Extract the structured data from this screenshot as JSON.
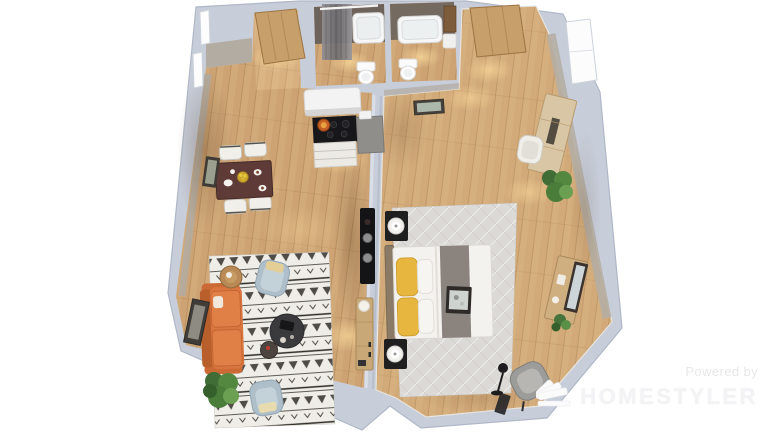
{
  "watermark": {
    "powered_by": "Powered by",
    "brand": "HOMESTYLER",
    "logo": "homestyler-fan-logo"
  },
  "scene": {
    "type": "3d-floor-plan-render",
    "view": "top-down dollhouse render of a one-bedroom apartment",
    "rooms": [
      {
        "name": "entry-hall",
        "items": [
          "wooden-front-door",
          "wood-floor"
        ]
      },
      {
        "name": "bathroom-left",
        "items": [
          "bathtub",
          "shower-curtain",
          "towel-bar",
          "toilet",
          "dark-taupe-walls"
        ]
      },
      {
        "name": "bathroom-right",
        "items": [
          "bathtub",
          "toilet",
          "vanity-cabinet"
        ]
      },
      {
        "name": "kitchen",
        "items": [
          "range-hood",
          "black-cooktop",
          "orange-pot",
          "white-drawer-cabinet",
          "gray-counter-cabinet"
        ]
      },
      {
        "name": "dining-area",
        "items": [
          "dark-wood-dining-table",
          "four-white-chairs",
          "plates",
          "fruit-bowl",
          "wall-art"
        ]
      },
      {
        "name": "living-room",
        "items": [
          "orange-sofa",
          "boho-patterned-rug",
          "round-coffee-table",
          "small-side-table",
          "two-blue-armchairs",
          "potted-plant",
          "leaning-picture-frame",
          "black-media-console",
          "wood-sideboard-with-lamp",
          "round-wood-tray-table"
        ]
      },
      {
        "name": "bedroom",
        "items": [
          "double-bed",
          "yellow-pillows",
          "gray-bed-runner",
          "two-black-nightstands",
          "round-white-lamps",
          "gray-area-rug",
          "vanity-dresser",
          "white-chair",
          "desk-with-mirror",
          "potted-plants",
          "gray-lounge-chair",
          "black-floor-lamp",
          "wooden-door",
          "window",
          "picture-frame"
        ]
      }
    ],
    "palette": {
      "background": "#ffffff",
      "wall": "#c7cdd9",
      "wall_edge": "#b0b7c6",
      "wall_face_greige": "#b2aca2",
      "bath_wall_dark": "#6e635a",
      "floor_wood": "#cda374",
      "sofa_orange": "#d97640",
      "armchair_blue": "#aebfca",
      "pillow_yellow": "#e6b63e",
      "dining_table": "#5e3b36",
      "rug_living": "#efede7",
      "rug_bedroom": "#dcdad6",
      "watermark_text": "#f3f3f5"
    }
  }
}
